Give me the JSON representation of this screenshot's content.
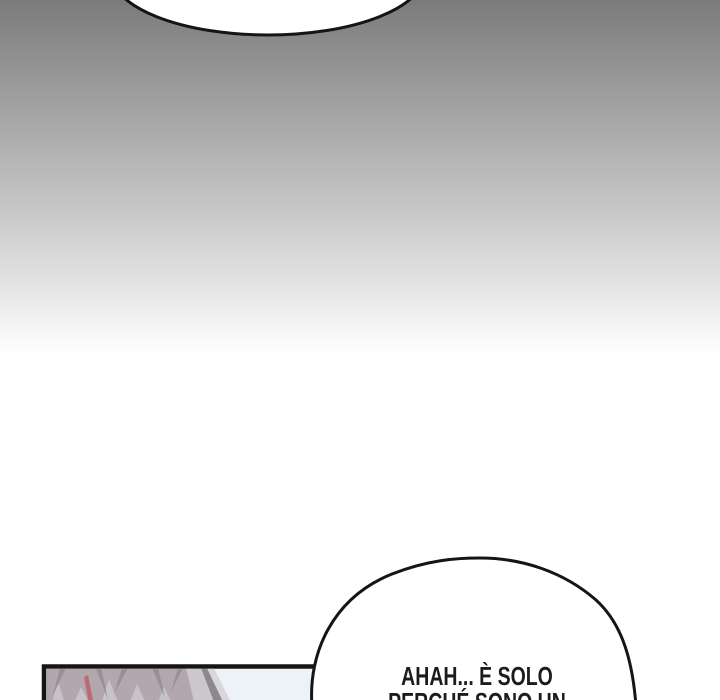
{
  "bubbles": {
    "top": {
      "text": ""
    },
    "bottom": {
      "lines": [
        "AHAH... È SOLO",
        "PERCHÉ SONO UN"
      ]
    }
  },
  "colors": {
    "gradient-top": "#7b7b7b",
    "gradient-mid": "#c9c9c9",
    "gradient-tail": "#fbfbfb",
    "paper-white": "#ffffff",
    "ink": "#151515",
    "bubble-fill": "#ffffff",
    "text-ink": "#1c1c1c",
    "panel-sky": "#edf2f6",
    "hair-mauve": "#b2a7ad",
    "hair-streak": "#9a8f97",
    "hair-light": "#c7c3c8",
    "hair-pink": "#bb6a75",
    "wedge-light": "#cbc7cc",
    "wedge-dark": "#8e8790",
    "wedge-pale": "#d9d7db"
  }
}
